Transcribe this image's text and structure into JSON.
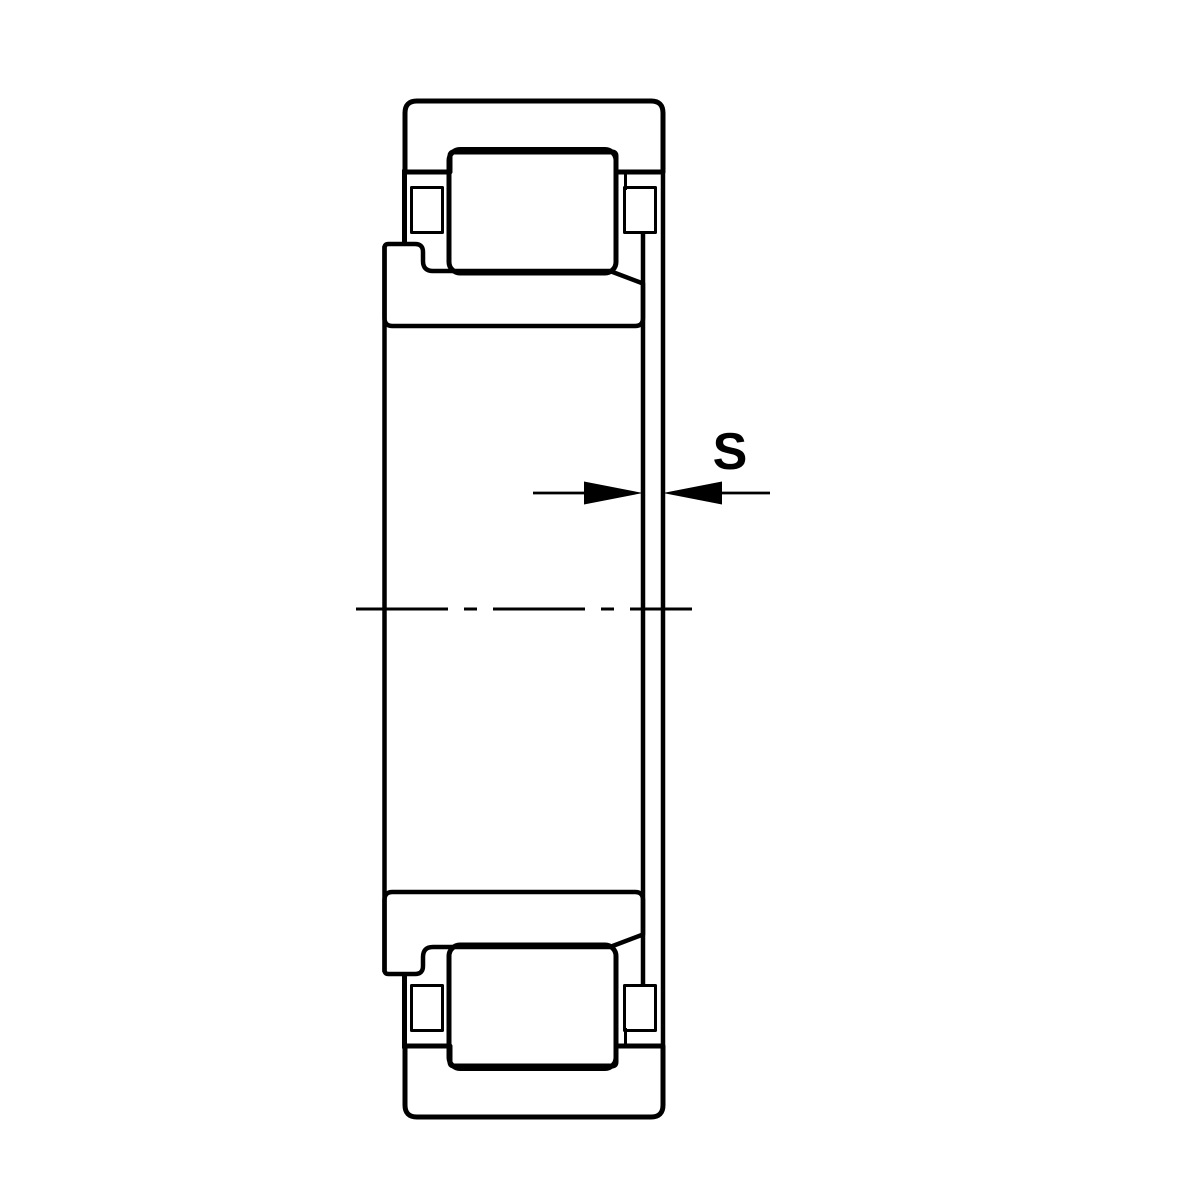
{
  "diagram": {
    "dimension_label": "S",
    "colors": {
      "line": "#000000",
      "background": "#ffffff"
    }
  }
}
